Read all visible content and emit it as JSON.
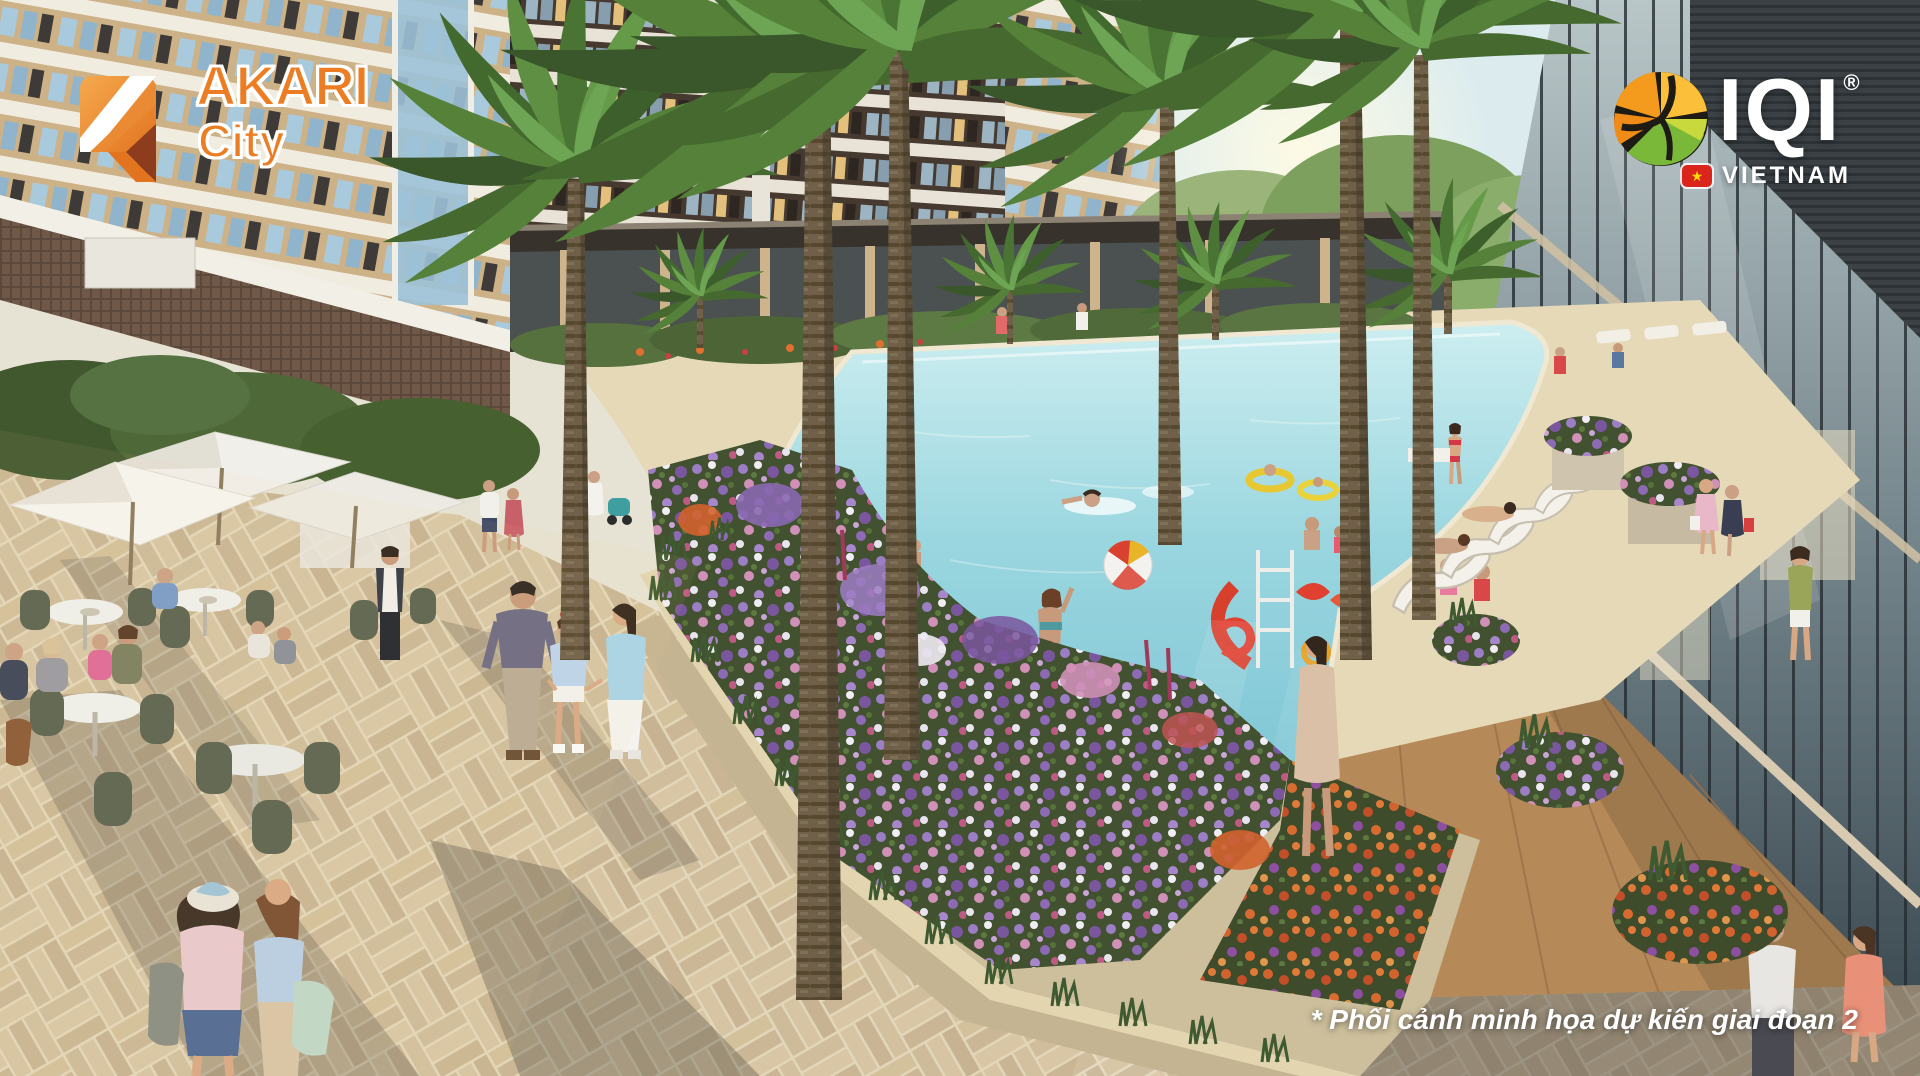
{
  "meta": {
    "title": "Akari City – phase 2 pool courtyard architectural rendering"
  },
  "branding": {
    "akari": {
      "title": "AKARI",
      "subtitle": "City",
      "orange": "#ED7D23",
      "orange_light": "#F5A94E",
      "accent_dark": "#8D3C1E"
    },
    "iqi": {
      "title": "IQI",
      "registered": "®",
      "subtitle": "VIETNAM",
      "text_color": "#FFFFFF",
      "globe_orange": "#F49A1C",
      "globe_amber": "#FBBF3A",
      "globe_green": "#7AB83A",
      "globe_lime": "#C8D93E",
      "globe_dark": "#1E1A14",
      "flag_red": "#DA251D",
      "flag_star": "★"
    }
  },
  "caption": {
    "text": "* Phối cảnh minh họa dự kiến giai đoạn 2",
    "color": "#FFFFFF"
  },
  "scene": {
    "description": "3D marketing rendering of a resort-style courtyard: large swimming pool with swimmers, beach ball, floats and a red water-play slide; palm trees; flower planters; outdoor cafe with white umbrellas; residents strolling a paved plaza; apartment towers behind and a glass retail promenade at right.",
    "palette": {
      "pool_water": "#8FD0DB",
      "pool_deck": "#E6D9B8",
      "paving_sunlit": "#D8C7A1",
      "paving_shadow": "#8F867B",
      "planter_wall": "#D6C8A4",
      "wood_deck": "#B68A58",
      "tower_dark": "#463A30",
      "tower_tan": "#CDB187",
      "glass_facade": "#5A6A72",
      "palm_green": "#4F7839",
      "flower_purple": "#8A68B0",
      "flower_orange": "#D2622E",
      "umbrella_white": "#F4F2EC"
    },
    "elements": [
      "apartment-towers",
      "retail-glass-promenade",
      "swimming-pool",
      "pool-deck",
      "palm-trees",
      "flower-planters",
      "planter-wall",
      "outdoor-cafe-umbrellas",
      "cafe-tables",
      "plaza-paving",
      "walking-family",
      "two-women-walking",
      "swimmers",
      "beach-ball",
      "pool-floats",
      "red-play-slide",
      "lounge-chairs",
      "shoppers",
      "waiter"
    ]
  }
}
